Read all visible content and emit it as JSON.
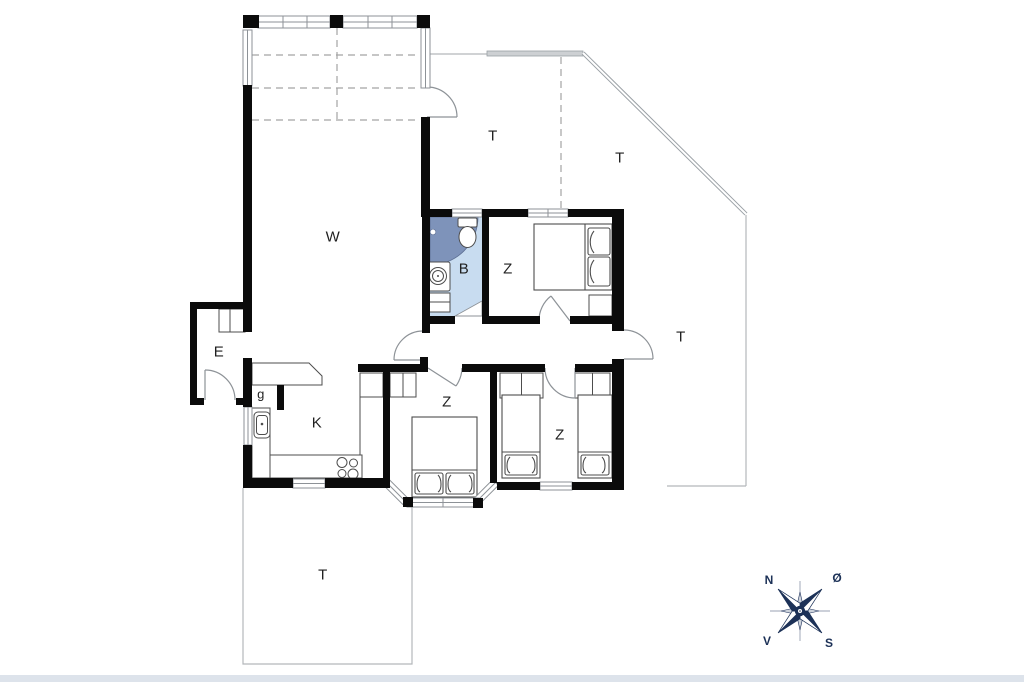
{
  "rooms": [
    {
      "id": "living-room",
      "label": "W"
    },
    {
      "id": "bathroom",
      "label": "B"
    },
    {
      "id": "bedroom-north",
      "label": "Z"
    },
    {
      "id": "bedroom-southwest",
      "label": "Z"
    },
    {
      "id": "bedroom-south",
      "label": "Z"
    },
    {
      "id": "entrance",
      "label": "E"
    },
    {
      "id": "kitchen",
      "label": "K"
    },
    {
      "id": "hall",
      "label": "g"
    },
    {
      "id": "terrace-north",
      "label": "T"
    },
    {
      "id": "terrace-northeast",
      "label": "T"
    },
    {
      "id": "terrace-east",
      "label": "T"
    },
    {
      "id": "terrace-south",
      "label": "T"
    }
  ],
  "compass": {
    "north": "N",
    "east": "Ø",
    "south": "S",
    "west": "V"
  },
  "colors": {
    "wall": "#0b0b0b",
    "bath_floor": "#c8dcf0",
    "shower": "#7e93ba",
    "compass_navy": "#1c3157",
    "window_line": "#8d9297",
    "terrace_line": "#b3b7bb",
    "bottom_band": "#dde3eb"
  }
}
